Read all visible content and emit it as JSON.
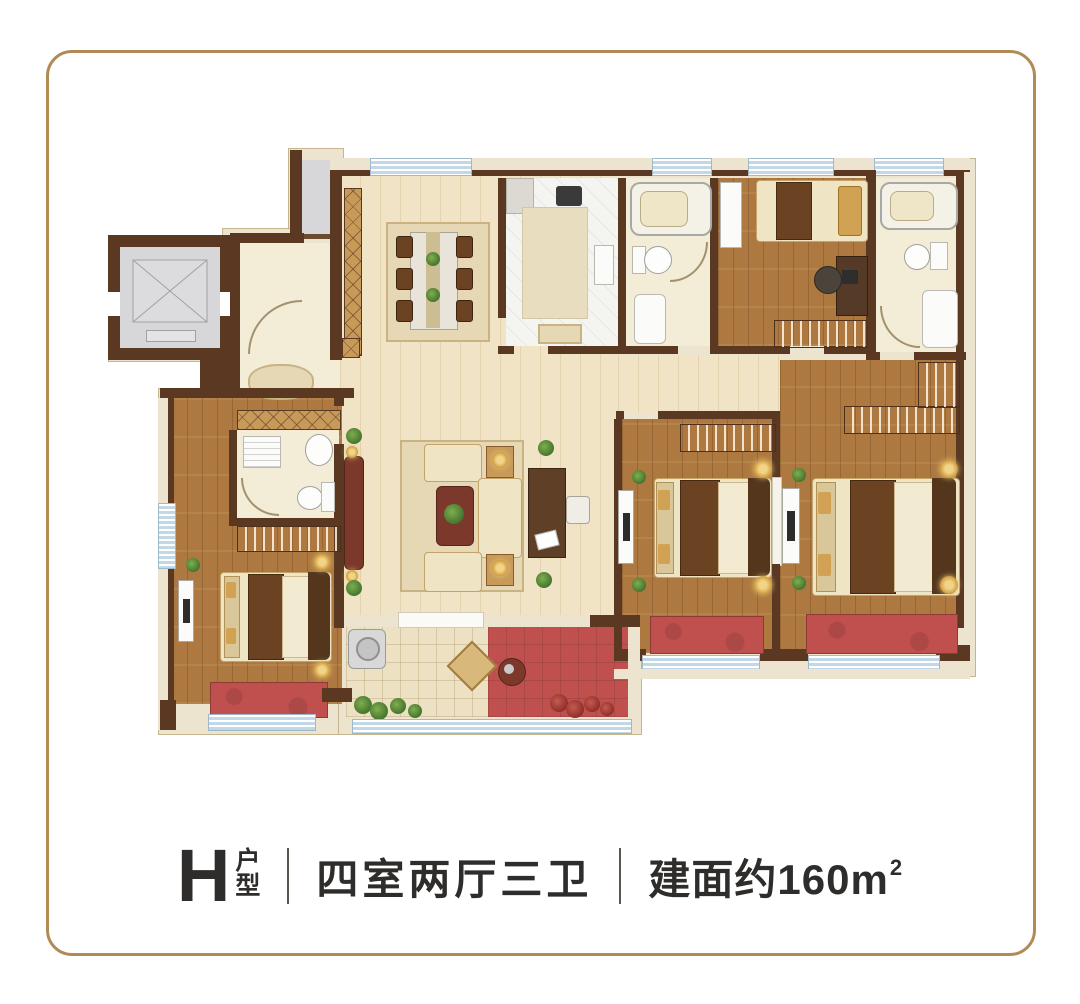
{
  "footer": {
    "plan_letter": "H",
    "plan_word_top": "户",
    "plan_word_bottom": "型",
    "rooms_text": "四室两厅三卫",
    "area_text": "建面约160m",
    "area_exponent": "2"
  },
  "colors": {
    "frame": "#b18b55",
    "wall": "#5a3822",
    "sill": "#ece4cf",
    "sill_edge": "#c6b68f",
    "floor_light": "#f1e3c5",
    "floor_wood": "#ad7940",
    "floor_gray": "#d7d7d9",
    "floor_tile": "#ece1c2",
    "bath": "#f3ecd6",
    "kitchen": "#f4f4f1",
    "carpet_red": "#c0504e",
    "window_blue": "#c2d8e6",
    "sofa_cream": "#efe4c4",
    "rug_tan": "#e6d8b4",
    "cabinet_tan": "#c89a5a",
    "furniture_dark": "#6b4323",
    "cabinet_red": "#7c392b",
    "lamp_gold": "#d2a254",
    "plant_green": "#4e7d34",
    "text": "#2f2d2b"
  }
}
